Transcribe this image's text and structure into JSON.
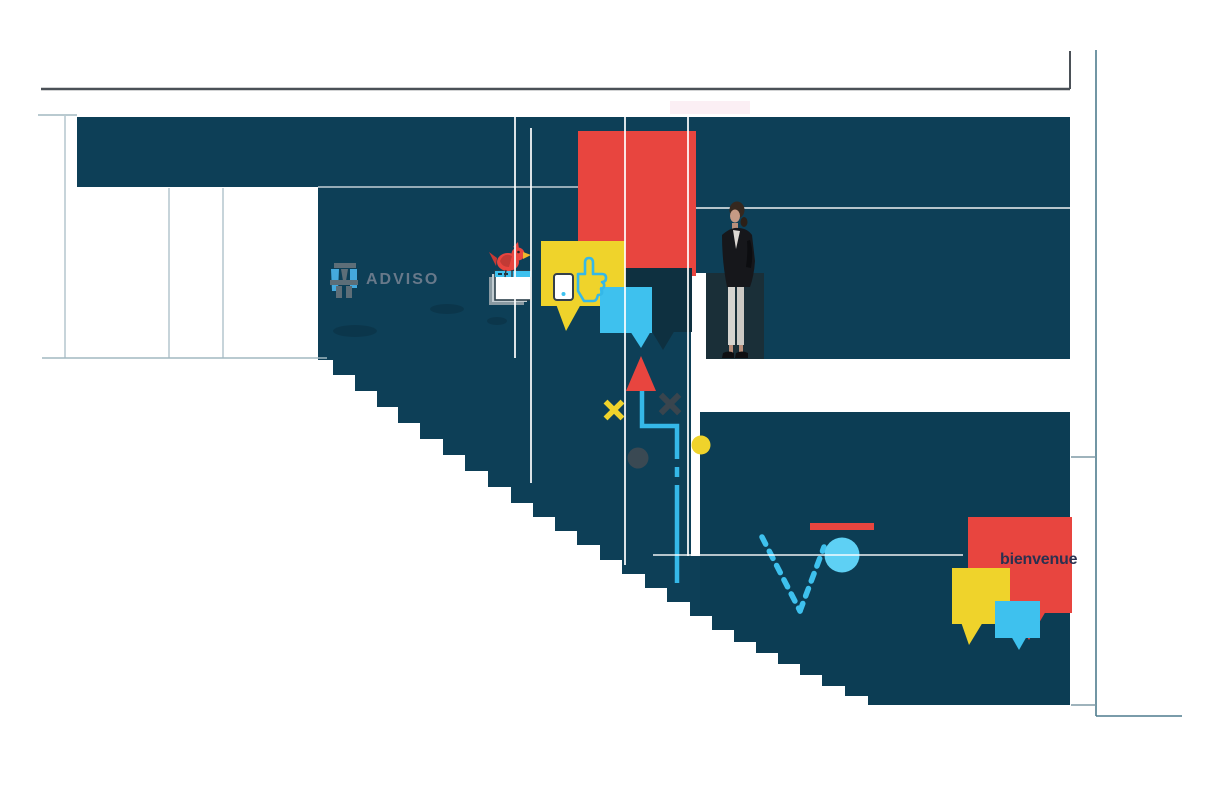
{
  "canvas": {
    "width": 1224,
    "height": 792,
    "background": "#ffffff"
  },
  "header": {
    "logo_text": "ADVISO"
  },
  "mural": {
    "welcome_text": "bienvenue",
    "elements": [
      "adviso-logo",
      "twitter-bird-on-browser-stack",
      "yellow-speech-bubble-with-thumbs-up-and-smartphone",
      "cyan-speech-bubble",
      "navy-speech-bubble",
      "red-speech-bubble",
      "standing-woman-photo",
      "up-arrow-with-elbow-path",
      "yellow-x-mark",
      "dark-x-mark",
      "yellow-dot",
      "dark-dot",
      "bouncing-ball-trajectory",
      "red-bar",
      "welcome-speech-bubble-cluster",
      "staircase-silhouette",
      "thin-frame-lines"
    ]
  },
  "colors": {
    "teal": "#0d3f57",
    "teal_block": "#0c3d54",
    "red": "#e8453f",
    "yellow": "#efd32b",
    "cyan": "#3ec1ee",
    "cyan_light": "#5ed0f4",
    "navy_bubble": "#0e3040",
    "backdrop": "#1a2f38",
    "frame_gray": "#4b5157",
    "frame_light": "#a2b8c1",
    "frame_teal": "#4e7c8e",
    "logo_gray": "#68798a",
    "welcome_ink": "#2a3150",
    "pink": "#fbeff4",
    "dark_mark": "#39454e"
  }
}
